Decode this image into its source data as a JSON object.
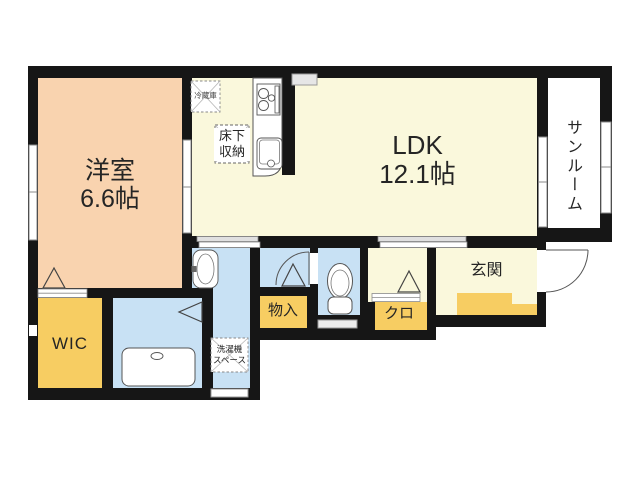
{
  "rooms": {
    "western_room": {
      "label": "洋室",
      "size": "6.6帖"
    },
    "ldk": {
      "label": "LDK",
      "size": "12.1帖"
    },
    "sunroom": {
      "label": "サンルーム"
    },
    "entrance": {
      "label": "玄関"
    },
    "wic": {
      "label": "WIC"
    },
    "storage": {
      "label": "物入"
    },
    "closet": {
      "label": "クロ"
    },
    "underfloor_storage": {
      "line1": "床下",
      "line2": "収納"
    },
    "refrigerator": {
      "label": "冷蔵庫"
    },
    "washer_space": {
      "line1": "洗濯機",
      "line2": "スペース"
    }
  },
  "colors": {
    "wall": "#161616",
    "room_peach": "#F9D3AF",
    "room_cream": "#FAF8DC",
    "room_yellow": "#F7CD62",
    "room_blue": "#C8E1F4",
    "room_white": "#FFFFFF"
  }
}
